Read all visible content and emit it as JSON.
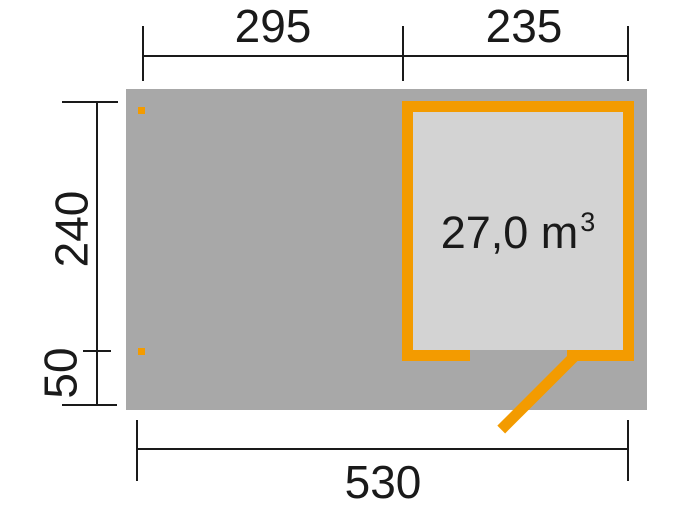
{
  "floorplan": {
    "volume": {
      "value": "27,0 m",
      "sup": "3"
    },
    "dimensions": {
      "top_left": "295",
      "top_right": "235",
      "left_upper": "240",
      "left_lower": "50",
      "bottom": "530"
    },
    "colors": {
      "base_gray": "#a8a8a8",
      "interior_gray": "#d3d3d3",
      "accent_orange": "#f39b00",
      "line_black": "#1a1a1a"
    }
  }
}
